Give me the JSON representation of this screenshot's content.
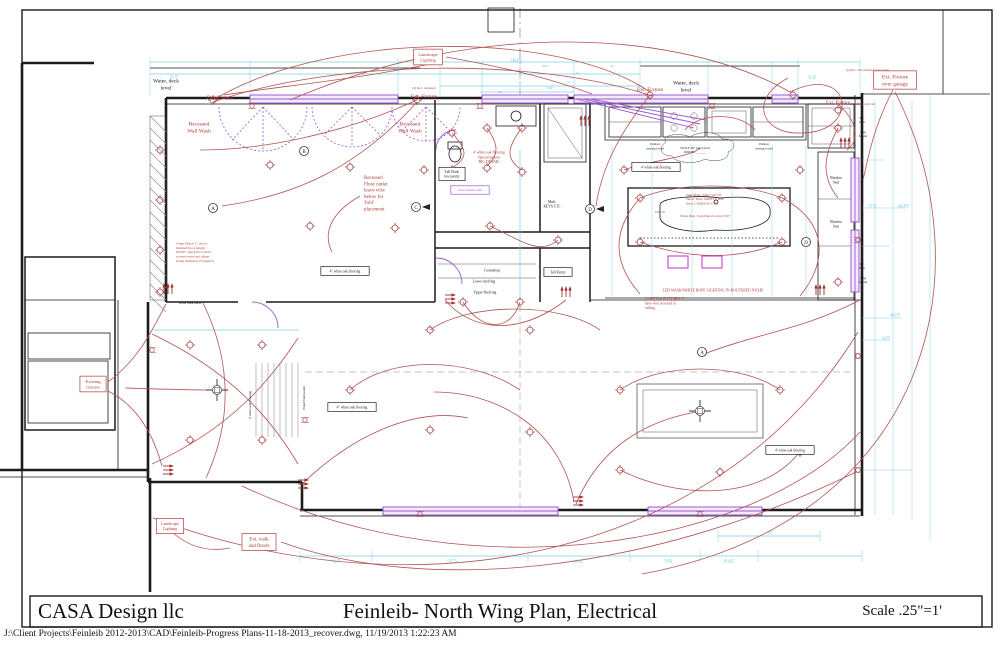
{
  "title_block": {
    "firm": "CASA Design llc",
    "title": "Feinleib- North Wing Plan, Electrical",
    "scale": "Scale .25\"=1'"
  },
  "footer_path": "J:\\Client Projects\\Feinleib 2012-2013\\CAD\\Feinleib-Progress Plans-11-18-2013_recover.dwg, 11/19/2013 1:22:23 AM",
  "colors": {
    "red": "#b03a3a",
    "black": "#222222",
    "cyan": "#3fb8d8",
    "purple": "#9b59d0",
    "wire": "#b25353",
    "wall": "#1b1b1b"
  },
  "plan_labels": [
    {
      "t": "Water, deck\nlevel",
      "x": 166,
      "y": 84,
      "s": 5.5,
      "c": "black"
    },
    {
      "t": "Ext. Fixture",
      "x": 220,
      "y": 97,
      "s": 5.5
    },
    {
      "t": "Recessed\nWall Wash",
      "x": 199,
      "y": 127,
      "s": 5.5
    },
    {
      "t": "Ext. Fixture",
      "x": 424,
      "y": 96,
      "s": 5.5
    },
    {
      "t": "(2) Rec. mounted",
      "x": 424,
      "y": 88,
      "s": 3.4
    },
    {
      "t": "Recessed\nWall Wash",
      "x": 410,
      "y": 127,
      "s": 5.5
    },
    {
      "t": "Landscape\nLighting",
      "x": 428,
      "y": 57,
      "s": 4.5,
      "box": true
    },
    {
      "t": "Ext. Fixture",
      "x": 650,
      "y": 89,
      "s": 5.5
    },
    {
      "t": "Water, deck\nlevel",
      "x": 686,
      "y": 86,
      "s": 5.5,
      "c": "black"
    },
    {
      "t": "Ext. Fixture",
      "x": 838,
      "y": 102,
      "s": 5
    },
    {
      "t": "Ext. Fixture\nover garage",
      "x": 895,
      "y": 80,
      "s": 5.5,
      "box": true
    },
    {
      "t": "(2) Rec. wire mounted wall outlet",
      "x": 846,
      "y": 70,
      "s": 3.2,
      "a": "start"
    },
    {
      "t": "wood/walk to wall cab",
      "x": 846,
      "y": 104,
      "s": 3.2,
      "a": "start"
    },
    {
      "t": "Recessed\nFloor outlet\nleave wire\nbelow for\n'fold'\nplacement",
      "x": 364,
      "y": 193,
      "s": 5,
      "a": "start"
    },
    {
      "t": "Some March 1\" above\nfinished floor height\nNOTE: check floor level\nscrews/wires and adjust\nframe thickness if required",
      "x": 176,
      "y": 252,
      "s": 3.5,
      "a": "start"
    },
    {
      "t": "4' white oak flooring\nSpecial pattern\n'BIG DETAIL'",
      "x": 489,
      "y": 157,
      "s": 3.8
    },
    {
      "t": "Tall Flush\nlow pantry",
      "x": 452,
      "y": 174,
      "s": 3.6,
      "c": "black",
      "box": true
    },
    {
      "t": "Wood flush outlet",
      "x": 470,
      "y": 190,
      "s": 3.4,
      "c": "purple",
      "box": true
    },
    {
      "t": "Mult:\nKEYS CTL",
      "x": 552,
      "y": 204,
      "s": 3.6,
      "c": "black"
    },
    {
      "t": "Tall Pantry",
      "x": 558,
      "y": 272,
      "s": 3.6,
      "c": "black",
      "box": true
    },
    {
      "t": "Countertop",
      "x": 492,
      "y": 270,
      "s": 3.6,
      "c": "black"
    },
    {
      "t": "Lower shelving",
      "x": 484,
      "y": 281,
      "s": 3.6,
      "c": "black"
    },
    {
      "t": "Upper Shelving",
      "x": 485,
      "y": 292,
      "s": 3.6,
      "c": "black"
    },
    {
      "t": "Pullout\ncutting board",
      "x": 655,
      "y": 146,
      "s": 3.4,
      "c": "black"
    },
    {
      "t": "Pullout\ncutting board",
      "x": 764,
      "y": 146,
      "s": 3.4,
      "c": "black"
    },
    {
      "t": "WOLF 48\" (dual fuel)\nMODEL ______",
      "x": 695,
      "y": 150,
      "s": 3.3,
      "c": "black"
    },
    {
      "t": "Sink: Bold \"Allia\" 510718\nfaucet: Brizo GREETY HSE\nInsta: GARBAGE CTL",
      "x": 686,
      "y": 199,
      "s": 3.3,
      "a": "start"
    },
    {
      "t": "Waste Disp. Switch/knob contol 9'10\"",
      "x": 680,
      "y": 216,
      "s": 3.3,
      "a": "start"
    },
    {
      "t": "DW 70",
      "x": 660,
      "y": 212,
      "s": 3.3
    },
    {
      "t": "LED WASH/WHITE ROPE LIGHTING IN ROUTERED NICHE",
      "x": 713,
      "y": 290,
      "s": 3.8
    },
    {
      "t": "LIGHTING FIXTURES ??\nhave wire recessed in\nceiling",
      "x": 645,
      "y": 303,
      "s": 3.6,
      "a": "start"
    },
    {
      "t": "4\" white oak flooring",
      "x": 345,
      "y": 271,
      "s": 3.6,
      "c": "black",
      "box": true
    },
    {
      "t": "4\" white oak flooring",
      "x": 352,
      "y": 407,
      "s": 3.6,
      "c": "black",
      "box": true
    },
    {
      "t": "4' white oak flooring",
      "x": 656,
      "y": 167,
      "s": 3.6,
      "c": "black",
      "box": true
    },
    {
      "t": "4' white oak flooring",
      "x": 790,
      "y": 450,
      "s": 3.6,
      "c": "black",
      "box": true
    },
    {
      "t": "4' white oak flooring",
      "x": 250,
      "y": 405,
      "s": 3.4,
      "c": "black",
      "r": -90
    },
    {
      "t": "Wood flush outlet",
      "x": 304,
      "y": 398,
      "s": 3.4,
      "c": "black",
      "r": -90
    },
    {
      "t": "Wood flush outlet",
      "x": 190,
      "y": 303,
      "s": 3.2,
      "c": "black"
    },
    {
      "t": "Window\nSeat",
      "x": 836,
      "y": 180,
      "s": 3.6,
      "c": "black"
    },
    {
      "t": "Window\nSeat",
      "x": 836,
      "y": 224,
      "s": 3.6,
      "c": "black"
    },
    {
      "t": "T.C.\nlight",
      "x": 862,
      "y": 120,
      "s": 3.2,
      "c": "black"
    },
    {
      "t": "Plug\nMount",
      "x": 863,
      "y": 134,
      "s": 3.2,
      "c": "black"
    },
    {
      "t": "T.C.\nlight",
      "x": 862,
      "y": 266,
      "s": 3.2,
      "c": "black"
    },
    {
      "t": "Plug\nMount",
      "x": 863,
      "y": 280,
      "s": 3.2,
      "c": "black"
    },
    {
      "t": "Existing\nfixtures",
      "x": 93,
      "y": 384,
      "s": 4.5,
      "box": true
    },
    {
      "t": "Landscape\nLighting",
      "x": 170,
      "y": 526,
      "s": 4.2,
      "box": true
    },
    {
      "t": "Ext. walk\nand floods",
      "x": 259,
      "y": 542,
      "s": 5,
      "box": true
    },
    {
      "t": "51.75",
      "x": 174,
      "y": 77,
      "s": 3.6,
      "c": "cyan"
    },
    {
      "t": "134.375",
      "x": 516,
      "y": 60,
      "s": 3.6,
      "c": "cyan"
    },
    {
      "t": "31.25",
      "x": 812,
      "y": 77,
      "s": 3.6,
      "c": "cyan"
    },
    {
      "t": "24.2",
      "x": 545,
      "y": 66,
      "s": 3.4,
      "c": "cyan"
    },
    {
      "t": "41",
      "x": 612,
      "y": 66,
      "s": 3.4,
      "c": "cyan"
    },
    {
      "t": "4.1",
      "x": 578,
      "y": 73,
      "s": 3.4,
      "c": "cyan"
    },
    {
      "t": "14",
      "x": 568,
      "y": 82,
      "s": 3.4,
      "c": "cyan"
    },
    {
      "t": "16.87",
      "x": 550,
      "y": 88,
      "s": 3.4,
      "c": "cyan"
    },
    {
      "t": "27",
      "x": 500,
      "y": 92,
      "s": 3.4,
      "c": "cyan"
    },
    {
      "t": "66.75",
      "x": 336,
      "y": 561,
      "s": 3.6,
      "c": "cyan"
    },
    {
      "t": "137.75",
      "x": 452,
      "y": 561,
      "s": 3.6,
      "c": "cyan"
    },
    {
      "t": "84.125",
      "x": 578,
      "y": 561,
      "s": 3.6,
      "c": "cyan"
    },
    {
      "t": "70.76",
      "x": 668,
      "y": 561,
      "s": 3.6,
      "c": "cyan"
    },
    {
      "t": "61.625",
      "x": 729,
      "y": 561,
      "s": 3.6,
      "c": "cyan"
    },
    {
      "t": "121",
      "x": 770,
      "y": 532,
      "s": 3.6,
      "c": "cyan"
    },
    {
      "t": "75.75",
      "x": 872,
      "y": 206,
      "s": 3.6,
      "c": "cyan"
    },
    {
      "t": "141.875",
      "x": 903,
      "y": 206,
      "s": 3.6,
      "c": "cyan"
    },
    {
      "t": "44.375",
      "x": 895,
      "y": 315,
      "s": 3.6,
      "c": "cyan"
    },
    {
      "t": "10.75",
      "x": 886,
      "y": 338,
      "s": 3.6,
      "c": "cyan"
    }
  ],
  "markers": [
    {
      "l": "A",
      "x": 213,
      "y": 208
    },
    {
      "l": "B",
      "x": 304,
      "y": 151
    },
    {
      "l": "C",
      "x": 416,
      "y": 207,
      "ar": true
    },
    {
      "l": "D",
      "x": 590,
      "y": 209,
      "ar": true
    },
    {
      "l": "A",
      "x": 702,
      "y": 352
    },
    {
      "l": "D",
      "x": 806,
      "y": 242
    }
  ]
}
